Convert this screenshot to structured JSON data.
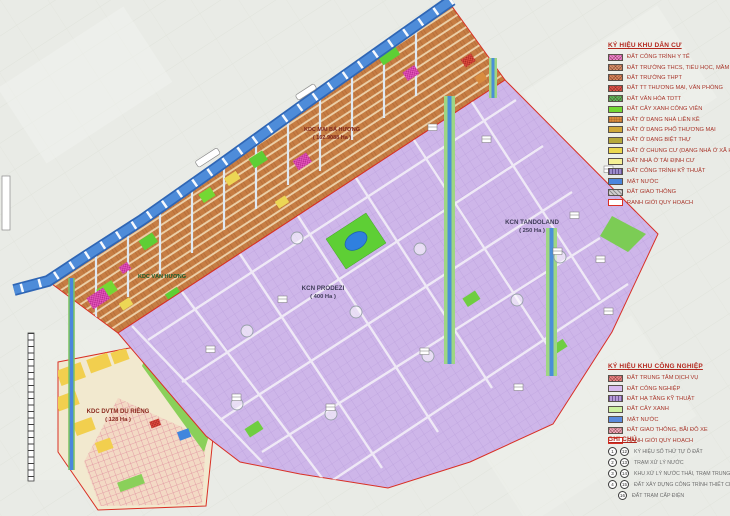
{
  "map": {
    "labels": {
      "mai_ba_huong": {
        "name": "KDC MAI BÁ HƯƠNG",
        "area": "( 162.9088 Ha )"
      },
      "van_huong": {
        "name": "KDC VẠN HƯƠNG"
      },
      "prodezi": {
        "name": "KCN PRODEZI",
        "area": "( 400 Ha )"
      },
      "tandoland": {
        "name": "KCN TANDOLAND",
        "area": "( 250 Ha )"
      },
      "dvtm": {
        "name": "KDC DVTM DU RIÊNG",
        "area": "( 128 Ha )"
      }
    },
    "colors": {
      "river": "#4e8cd9",
      "residential_base": "#c67d43",
      "industrial_base": "#ceb6e9",
      "boundary": "#d93025",
      "green_park": "#5ecf35",
      "dvtm_base": "#f2e9cf"
    }
  },
  "legend_residential": {
    "title": "KÝ HIỆU KHU DÂN CƯ",
    "items": [
      {
        "label": "ĐẤT CÔNG TRÌNH Y TẾ",
        "color": "#ef82cf",
        "pattern": "crosshatch"
      },
      {
        "label": "ĐẤT TRƯỜNG THCS, TIỂU HỌC, MẦM NON",
        "color": "#d8926a",
        "pattern": "crosshatch"
      },
      {
        "label": "ĐẤT TRƯỜNG THPT",
        "color": "#d8875c",
        "pattern": "crosshatch"
      },
      {
        "label": "ĐẤT TT THƯƠNG MẠI, VĂN PHÒNG",
        "color": "#e0544a",
        "pattern": "crosshatch"
      },
      {
        "label": "ĐẤT VĂN HÓA TDTT",
        "color": "#5cb85c",
        "pattern": "crosshatch"
      },
      {
        "label": "ĐẤT CÂY XANH CÔNG VIÊN",
        "color": "#74d833",
        "pattern": "solid"
      },
      {
        "label": "ĐẤT Ở DẠNG NHÀ LIỀN KỀ",
        "color": "#d98c3f",
        "pattern": "grid"
      },
      {
        "label": "ĐẤT Ở DẠNG PHỐ THƯƠNG MẠI",
        "color": "#cfa83a",
        "pattern": "solid"
      },
      {
        "label": "ĐẤT Ở DẠNG BIỆT THỰ",
        "color": "#b5a83c",
        "pattern": "solid"
      },
      {
        "label": "ĐẤT Ở CHUNG CƯ (DẠNG NHÀ Ở XÃ HỘI)",
        "color": "#ecd84e",
        "pattern": "solid"
      },
      {
        "label": "ĐẤT NHÀ Ở TÁI ĐỊNH CƯ",
        "color": "#f5f096",
        "pattern": "solid"
      },
      {
        "label": "ĐẤT CÔNG TRÌNH KỸ THUẬT",
        "color": "#9b8ccb",
        "pattern": "stripes"
      },
      {
        "label": "MẶT NƯỚC",
        "color": "#4a86dd",
        "pattern": "solid"
      },
      {
        "label": "ĐẤT GIAO THÔNG",
        "color": "#cfcfcf",
        "pattern": "stripes"
      },
      {
        "label": "RANH GIỚI QUY HOẠCH",
        "color": "#ffffff",
        "pattern": "outline-red"
      }
    ]
  },
  "legend_industrial": {
    "title": "KÝ HIỆU KHU CÔNG NGHIỆP",
    "items": [
      {
        "label": "ĐẤT TRUNG TÂM DỊCH VỤ",
        "color": "#ec8585",
        "pattern": "crosshatch"
      },
      {
        "label": "ĐẤT CÔNG NGHIỆP",
        "color": "#d6baee",
        "pattern": "solid"
      },
      {
        "label": "ĐẤT HẠ TẦNG KỸ THUẬT",
        "color": "#b79ad8",
        "pattern": "stripes"
      },
      {
        "label": "ĐẤT CÂY XANH",
        "color": "#cdf0a0",
        "pattern": "solid"
      },
      {
        "label": "MẶT NƯỚC",
        "color": "#5a8ade",
        "pattern": "solid"
      },
      {
        "label": "ĐẤT GIAO THÔNG, BÃI ĐỖ XE",
        "color": "#f0a8ba",
        "pattern": "crosshatch"
      },
      {
        "label": "RANH GIỚI QUY HOẠCH",
        "color": "#ffffff",
        "pattern": "outline-red"
      }
    ]
  },
  "notes": {
    "title": "GHI CHÚ",
    "items": [
      {
        "symbols": [
          "1",
          "12"
        ],
        "label": "KÝ HIỆU SỐ THỨ TỰ Ô ĐẤT"
      },
      {
        "symbols": [
          "2",
          "13"
        ],
        "label": "TRẠM XỬ LÝ NƯỚC"
      },
      {
        "symbols": [
          "3",
          "14"
        ],
        "label": "KHU XỬ LÝ NƯỚC THẢI, TRẠM TRUNG CHUYỂN RÁC THẢI"
      },
      {
        "symbols": [
          "4",
          "15"
        ],
        "label": "ĐẤT XÂY DỰNG CÔNG TRÌNH THIẾT CHẾ VĂN HÓA"
      },
      {
        "symbols": [
          "16"
        ],
        "label": "ĐẤT TRẠM CẤP ĐIỆN"
      }
    ]
  }
}
